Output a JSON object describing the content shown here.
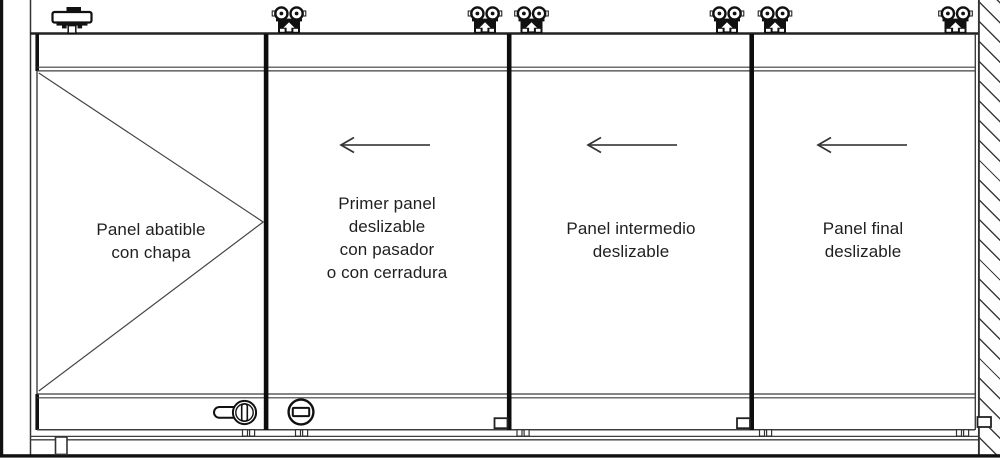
{
  "diagram": {
    "panels": [
      {
        "name": "hinged-panel",
        "label": [
          "Panel abatible",
          "con chapa"
        ]
      },
      {
        "name": "first-sliding-panel",
        "label": [
          "Primer panel",
          "deslizable",
          "con pasador",
          "o con cerradura"
        ]
      },
      {
        "name": "intermediate-sliding-panel",
        "label": [
          "Panel intermedio",
          "deslizable"
        ]
      },
      {
        "name": "final-sliding-panel",
        "label": [
          "Panel final",
          "deslizable"
        ]
      }
    ],
    "icons": [
      {
        "name": "pivot-hinge-icon",
        "count": 1
      },
      {
        "name": "roller-trolley-icon",
        "count": 6
      },
      {
        "name": "arrow-left-icon",
        "count": 3
      },
      {
        "name": "lock-cylinder-handle-icon",
        "count": 1
      },
      {
        "name": "flush-pull-icon",
        "count": 1
      },
      {
        "name": "keeper-bracket-icon",
        "count": 3
      },
      {
        "name": "floor-guide-icon",
        "count": 1
      },
      {
        "name": "wall-hatch",
        "count": 1
      }
    ],
    "colors": {
      "background": "#ffffff",
      "line": "#3f3f3f",
      "line_strong": "#111111",
      "text": "#1f1f1f"
    }
  }
}
